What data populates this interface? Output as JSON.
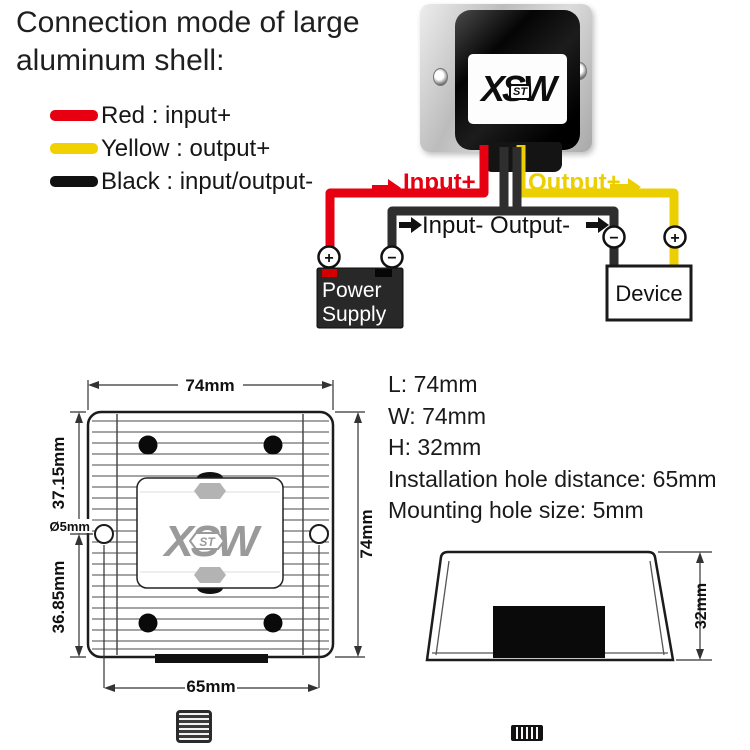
{
  "title": {
    "line1": "Connection mode of large",
    "line2": "aluminum shell:"
  },
  "legend": {
    "items": [
      {
        "name": "red",
        "color": "#e60012",
        "label": "Red : input+"
      },
      {
        "name": "yellow",
        "color": "#f2d100",
        "label": "Yellow : output+"
      },
      {
        "name": "black",
        "color": "#111111",
        "label": "Black : input/output-"
      }
    ]
  },
  "brand": {
    "logo": "XSW",
    "logo_sub": "ST"
  },
  "wiring": {
    "labels": {
      "input_plus": "Input+",
      "output_plus": "Output+",
      "input_output_minus": "Input- Output-"
    },
    "power_supply": {
      "line1": "Power",
      "line2": "Supply"
    },
    "device": "Device",
    "terminals": {
      "plus": "+",
      "minus": "−"
    },
    "wire_colors": {
      "red": "#e60012",
      "yellow": "#eccf00",
      "black": "#2e2e2e"
    }
  },
  "specs": {
    "length": "L: 74mm",
    "width": "W: 74mm",
    "height": "H: 32mm",
    "hole_distance": "Installation hole distance: 65mm",
    "hole_size": "Mounting hole size: 5mm"
  },
  "top_view": {
    "dim_top": "74mm",
    "dim_right": "74mm",
    "dim_upper_left": "37.15mm",
    "dim_lower_left": "36.85mm",
    "dim_hole": "Ø5mm",
    "dim_bottom": "65mm"
  },
  "side_view": {
    "dim_height": "32mm"
  }
}
